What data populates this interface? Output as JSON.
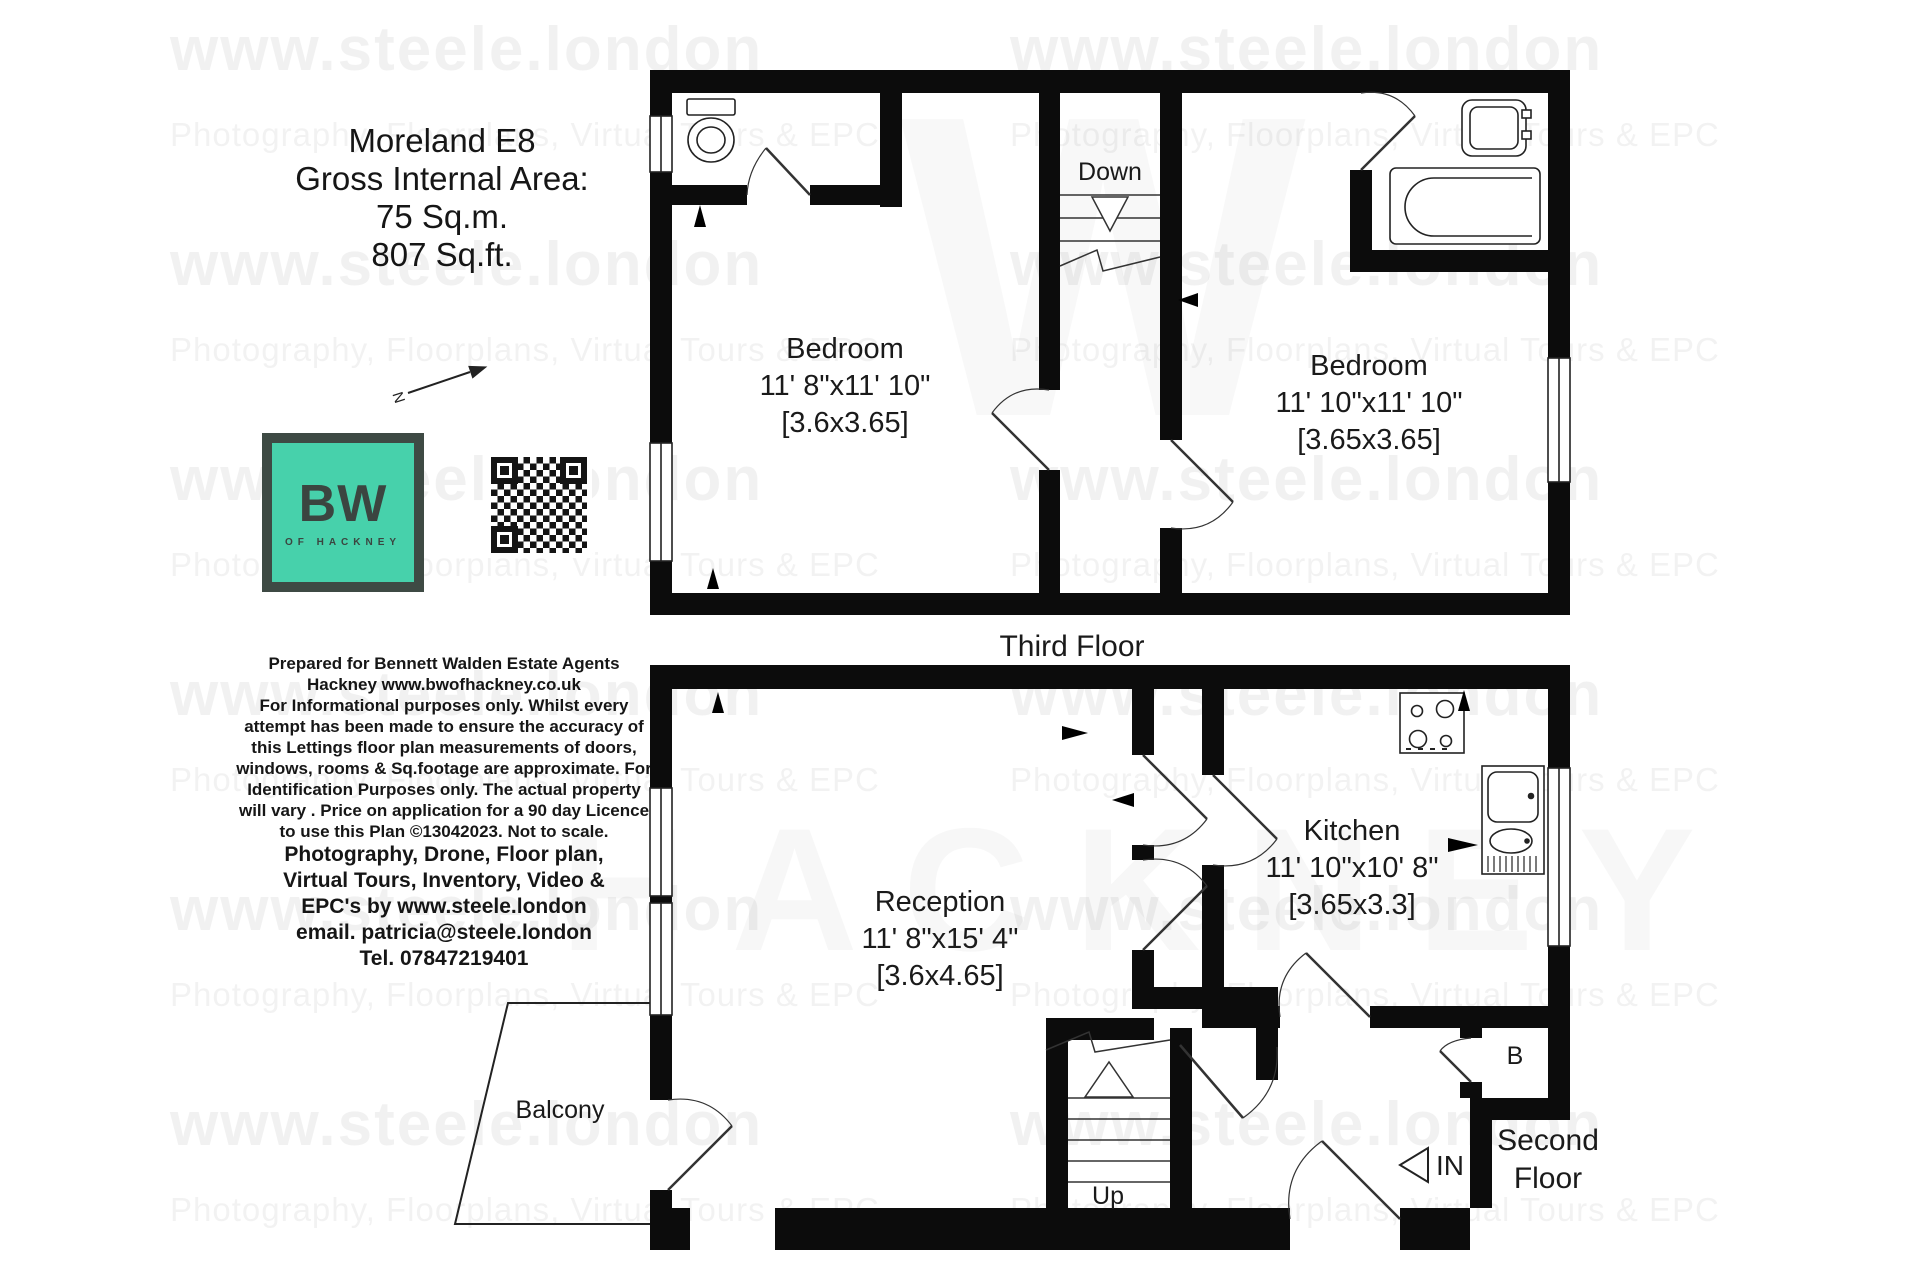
{
  "header": {
    "title": "Moreland E8",
    "subtitle": "Gross Internal Area:",
    "area_sqm": "75 Sq.m.",
    "area_sqft": "807 Sq.ft."
  },
  "logo": {
    "text": "BW",
    "sub": "OF HACKNEY",
    "color": "#47d1ab"
  },
  "compass": {
    "north": "N"
  },
  "watermark": {
    "site": "www.steele.london",
    "services": "Photography, Floorplans, Virtual Tours & EPC",
    "giant_letter": "W",
    "giant_word": "HACKNEY"
  },
  "disclaimer": {
    "lines": [
      "Prepared for Bennett Walden Estate Agents",
      "Hackney   www.bwofhackney.co.uk",
      "For Informational purposes only. Whilst every",
      "attempt has been made to ensure the accuracy of",
      "this Lettings floor plan measurements of doors,",
      "windows, rooms & Sq.footage are approximate. For",
      "Identification Purposes only. The actual property",
      "will vary . Price on application for a 90 day Licence",
      "to use this Plan ©13042023. Not to scale."
    ]
  },
  "contact": {
    "lines": [
      "Photography, Drone,  Floor plan,",
      "Virtual Tours,  Inventory,  Video  &",
      "EPC's   by www.steele.london",
      "email. patricia@steele.london",
      "Tel. 07847219401"
    ]
  },
  "third_floor": {
    "label": "Third Floor",
    "stairs": "Down",
    "bedroom1": {
      "name": "Bedroom",
      "imperial": "11' 8\"x11' 10\"",
      "metric": "[3.6x3.65]"
    },
    "bedroom2": {
      "name": "Bedroom",
      "imperial": "11' 10\"x11' 10\"",
      "metric": "[3.65x3.65]"
    }
  },
  "second_floor": {
    "label_line1": "Second",
    "label_line2": "Floor",
    "stairs": "Up",
    "entry": "IN",
    "boiler": "B",
    "balcony": "Balcony",
    "reception": {
      "name": "Reception",
      "imperial": "11' 8\"x15' 4\"",
      "metric": "[3.6x4.65]"
    },
    "kitchen": {
      "name": "Kitchen",
      "imperial": "11' 10\"x10' 8\"",
      "metric": "[3.65x3.3]"
    }
  }
}
